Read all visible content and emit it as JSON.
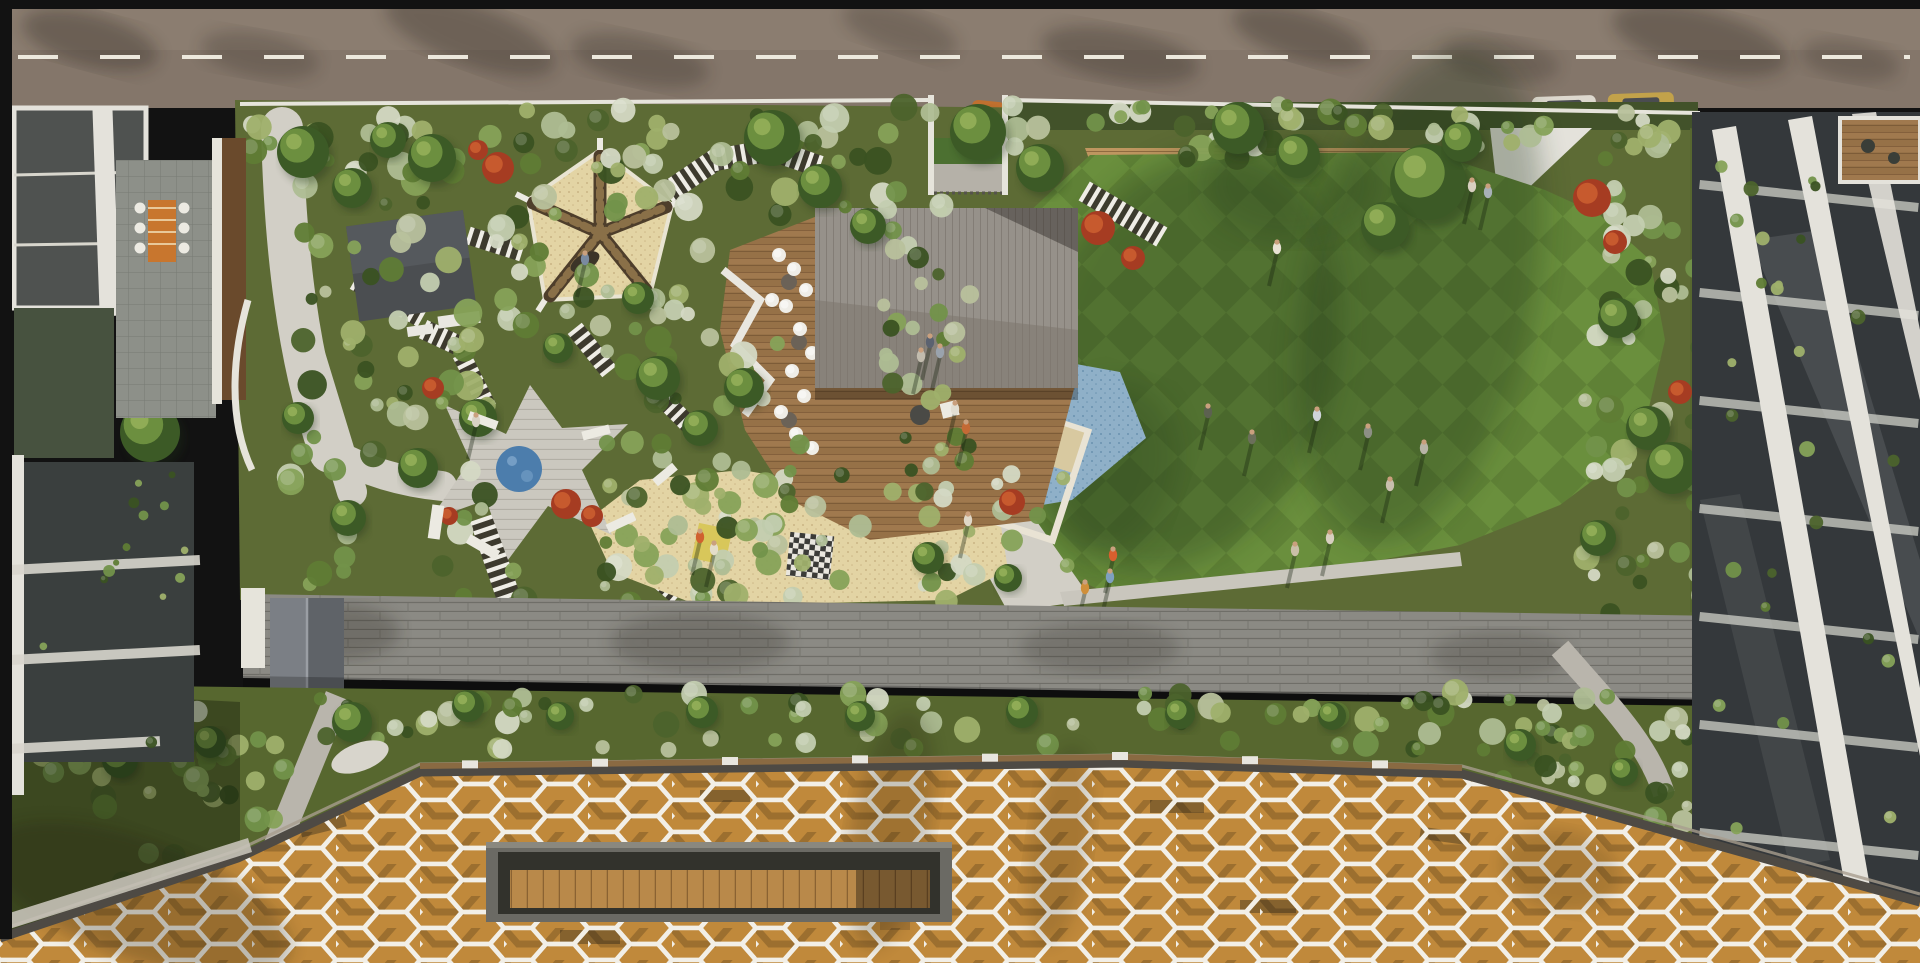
{
  "meta": {
    "description": "Aerial 3D render of a rooftop amenity garden podium between apartment buildings: road with dashed line and parked cars at top, landscaped garden with pavilion, spoke shade tent, spa deck, splash pad, sand play area, striped paths and striped lawn, long stone wall, planting band, and a white hexagonal lattice canopy over a timber roof with a sunken bench void at the bottom.",
    "width": 1920,
    "height": 963
  },
  "palette": {
    "frame": "#121212",
    "road_base": "#84766a",
    "road_light": "#97897a",
    "road_line": "#ece8dd",
    "parapet": "#e6e4db",
    "garden_base": "#5d6b35",
    "hedge_dark": "#42522a",
    "path_light": "#d2cfc6",
    "stripe_white": "#efede6",
    "stripe_dark": "#3a352e",
    "tent_sand": "#d7c89f",
    "tent_arm": "#4e3e2b",
    "tent_arm_stripe": "#8a7048",
    "cabana_roof": "#4b4e51",
    "pavilion_light": "#96918a",
    "pavilion_dark": "#7d776e",
    "deck_wood": "#a0794e",
    "deck_wood_dark": "#7d5c38",
    "deck_light": "#cbc8bf",
    "pool_blue": "#4c7dac",
    "splash_base": "#8fb0c8",
    "splash_dot": "#5f88a8",
    "sand_base": "#e3d4a4",
    "sand_dot": "#c2ab7a",
    "lawn_a": "#5f8136",
    "lawn_b": "#6a8f3d",
    "brick": "#bf9660",
    "brick_line": "#8f6b40",
    "bench_white": "#eceae2",
    "wall_stone": "#8b8a84",
    "wall_joint": "#6f6e68",
    "band_green": "#57672f",
    "canopy_wood": "#c9913f",
    "canopy_wood_dark": "#a87430",
    "lattice": "#f2efe7",
    "fascia": "#4e4a44",
    "void_frame": "#6b6a64",
    "void_dark": "#32322c",
    "void_bench": "#b9894a",
    "bldg_white": "#e4e2db",
    "bldg_glass": "#34383b",
    "bldg_glass2": "#4f5250",
    "tile": "#8d9089",
    "wood_wall": "#6a4a2c",
    "terracotta": "#a95f33",
    "skin": "#caa07e"
  },
  "shrub_colors": {
    "greens": [
      "#4c632c",
      "#5f7c35",
      "#72924a",
      "#86a258",
      "#9fb06b",
      "#3a5222"
    ],
    "sages": [
      "#aebd94",
      "#c3cdb0",
      "#d4d9c4",
      "#b8c19c"
    ]
  },
  "zones": [
    {
      "layer": "podium",
      "x": 245,
      "y": 106,
      "w": 690,
      "h": 110,
      "count": 60,
      "mix": "mixed",
      "rmin": 6,
      "rmax": 15
    },
    {
      "layer": "podium",
      "x": 1010,
      "y": 104,
      "w": 680,
      "h": 58,
      "count": 52,
      "mix": "mixed",
      "rmin": 6,
      "rmax": 14
    },
    {
      "layer": "podium",
      "x": 500,
      "y": 128,
      "w": 220,
      "h": 205,
      "count": 24,
      "mix": "mixed",
      "rmin": 6,
      "rmax": 13
    },
    {
      "layer": "podium",
      "x": 290,
      "y": 140,
      "w": 240,
      "h": 460,
      "count": 70,
      "mix": "mixed",
      "rmin": 6,
      "rmax": 15
    },
    {
      "layer": "podium",
      "x": 600,
      "y": 320,
      "w": 200,
      "h": 285,
      "count": 55,
      "mix": "mixed",
      "rmin": 6,
      "rmax": 14
    },
    {
      "layer": "podium",
      "x": 862,
      "y": 200,
      "w": 108,
      "h": 290,
      "count": 30,
      "mix": "mixed",
      "rmin": 6,
      "rmax": 12
    },
    {
      "layer": "podium",
      "x": 600,
      "y": 470,
      "w": 470,
      "h": 135,
      "count": 42,
      "mix": "mixed",
      "rmin": 5,
      "rmax": 12
    },
    {
      "layer": "podium",
      "x": 1585,
      "y": 118,
      "w": 120,
      "h": 500,
      "count": 55,
      "mix": "mixed",
      "rmin": 6,
      "rmax": 14
    },
    {
      "layer": "band",
      "x": 30,
      "y": 692,
      "w": 1660,
      "h": 58,
      "count": 95,
      "mix": "mixed",
      "rmin": 6,
      "rmax": 14
    },
    {
      "layer": "band",
      "x": 40,
      "y": 742,
      "w": 260,
      "h": 160,
      "count": 40,
      "mix": "greens",
      "rmin": 6,
      "rmax": 13
    },
    {
      "layer": "band",
      "x": 1450,
      "y": 728,
      "w": 320,
      "h": 115,
      "count": 35,
      "mix": "mixed",
      "rmin": 5,
      "rmax": 12
    },
    {
      "layer": "leftbalc",
      "x": 26,
      "y": 470,
      "w": 165,
      "h": 280,
      "count": 14,
      "mix": "greens",
      "rmin": 3,
      "rmax": 6
    },
    {
      "layer": "rightbalc",
      "x": 1716,
      "y": 145,
      "w": 185,
      "h": 690,
      "count": 26,
      "mix": "greens",
      "rmin": 4,
      "rmax": 8
    }
  ],
  "trees": [
    [
      303,
      152,
      26
    ],
    [
      352,
      188,
      20
    ],
    [
      432,
      158,
      24
    ],
    [
      388,
      140,
      18
    ],
    [
      772,
      138,
      28
    ],
    [
      820,
      186,
      22
    ],
    [
      868,
      226,
      18
    ],
    [
      978,
      132,
      28
    ],
    [
      1040,
      168,
      24
    ],
    [
      1238,
      128,
      26
    ],
    [
      1298,
      156,
      22
    ],
    [
      1428,
      182,
      38
    ],
    [
      1385,
      226,
      24
    ],
    [
      1462,
      142,
      20
    ],
    [
      658,
      378,
      22
    ],
    [
      700,
      428,
      18
    ],
    [
      744,
      388,
      20
    ],
    [
      638,
      298,
      16
    ],
    [
      558,
      348,
      15
    ],
    [
      478,
      418,
      19
    ],
    [
      418,
      468,
      20
    ],
    [
      348,
      518,
      18
    ],
    [
      298,
      418,
      16
    ],
    [
      1618,
      318,
      20
    ],
    [
      1648,
      428,
      22
    ],
    [
      1598,
      538,
      18
    ],
    [
      928,
      558,
      16
    ],
    [
      1008,
      578,
      14
    ],
    [
      1672,
      468,
      26
    ],
    [
      150,
      432,
      30
    ],
    [
      205,
      372,
      20
    ]
  ],
  "band_trees": [
    [
      352,
      722,
      20
    ],
    [
      468,
      706,
      16
    ],
    [
      560,
      716,
      14
    ],
    [
      702,
      712,
      16
    ],
    [
      860,
      716,
      15
    ],
    [
      1022,
      712,
      16
    ],
    [
      1180,
      714,
      15
    ],
    [
      1332,
      716,
      14
    ],
    [
      1520,
      745,
      16
    ],
    [
      1624,
      772,
      14
    ],
    [
      120,
      760,
      18
    ],
    [
      210,
      742,
      16
    ]
  ],
  "red_bushes": [
    [
      498,
      168,
      16
    ],
    [
      478,
      150,
      10
    ],
    [
      1098,
      228,
      17
    ],
    [
      1133,
      258,
      12
    ],
    [
      433,
      388,
      11
    ],
    [
      1012,
      502,
      13
    ],
    [
      1592,
      198,
      19
    ],
    [
      1615,
      242,
      12
    ],
    [
      566,
      504,
      15
    ],
    [
      592,
      516,
      11
    ],
    [
      449,
      516,
      9
    ],
    [
      1680,
      392,
      12
    ]
  ],
  "stripes": [
    {
      "x1": 668,
      "y1": 192,
      "x2": 715,
      "y2": 160,
      "w": 22
    },
    {
      "x1": 715,
      "y1": 160,
      "x2": 772,
      "y2": 150,
      "w": 22
    },
    {
      "x1": 772,
      "y1": 150,
      "x2": 818,
      "y2": 166,
      "w": 22
    },
    {
      "x1": 1086,
      "y1": 192,
      "x2": 1160,
      "y2": 236,
      "w": 22
    },
    {
      "x1": 470,
      "y1": 236,
      "x2": 520,
      "y2": 252,
      "w": 18
    },
    {
      "x1": 425,
      "y1": 330,
      "x2": 468,
      "y2": 350,
      "w": 20
    },
    {
      "x1": 462,
      "y1": 356,
      "x2": 487,
      "y2": 406,
      "w": 18
    },
    {
      "x1": 576,
      "y1": 330,
      "x2": 608,
      "y2": 370,
      "w": 18
    },
    {
      "x1": 652,
      "y1": 388,
      "x2": 698,
      "y2": 434,
      "w": 18
    },
    {
      "x1": 482,
      "y1": 520,
      "x2": 508,
      "y2": 596,
      "w": 24
    },
    {
      "x1": 634,
      "y1": 560,
      "x2": 676,
      "y2": 596,
      "w": 16
    },
    {
      "x1": 356,
      "y1": 282,
      "x2": 420,
      "y2": 318,
      "w": 18
    }
  ],
  "cars": [
    {
      "x": 971,
      "y": 101,
      "w": 33,
      "h": 31,
      "rot": 6,
      "body": "#c0702f",
      "cabin": "#33343a"
    },
    {
      "x": 1532,
      "y": 96,
      "w": 64,
      "h": 20,
      "rot": -2,
      "body": "#ddd8ce",
      "cabin": "#4a4c50"
    },
    {
      "x": 1608,
      "y": 93,
      "w": 66,
      "h": 22,
      "rot": -2,
      "body": "#c2a24a",
      "cabin": "#4a4c50"
    }
  ],
  "lawn_people": [
    [
      1277,
      248,
      "#e8e2d4"
    ],
    [
      1252,
      438,
      "#6b6f5a"
    ],
    [
      1317,
      415,
      "#cfd4da"
    ],
    [
      1368,
      432,
      "#8d8f85"
    ],
    [
      1424,
      448,
      "#b8b4a6"
    ],
    [
      1390,
      485,
      "#c8bfae"
    ],
    [
      1330,
      538,
      "#d8cfc0"
    ],
    [
      1295,
      550,
      "#cabfa8"
    ],
    [
      1208,
      412,
      "#5c6150"
    ],
    [
      1472,
      186,
      "#d8d0c0"
    ],
    [
      1488,
      192,
      "#a8b0b8"
    ]
  ],
  "misc_people": [
    [
      585,
      259,
      "#7a8aa0"
    ],
    [
      476,
      421,
      "#d8d2c4"
    ],
    [
      955,
      409,
      "#e2ded2"
    ],
    [
      966,
      428,
      "#c46a35"
    ],
    [
      700,
      537,
      "#d0612f"
    ],
    [
      714,
      549,
      "#e4ddc9"
    ],
    [
      930,
      342,
      "#5b6270"
    ],
    [
      940,
      352,
      "#9aa3ad"
    ],
    [
      921,
      356,
      "#c2bcae"
    ],
    [
      1113,
      555,
      "#d95f2e"
    ],
    [
      1110,
      577,
      "#7fa0c0"
    ],
    [
      1085,
      588,
      "#cf8f3a"
    ],
    [
      968,
      520,
      "#e0d8c8"
    ],
    [
      686,
      662,
      "#d06a2a"
    ]
  ],
  "white_benches": [
    [
      468,
      416,
      30,
      9,
      20
    ],
    [
      582,
      428,
      28,
      9,
      -15
    ],
    [
      466,
      542,
      34,
      10,
      30
    ],
    [
      606,
      518,
      30,
      9,
      -25
    ],
    [
      430,
      505,
      12,
      34,
      8
    ],
    [
      652,
      470,
      26,
      9,
      -40
    ]
  ],
  "stools": [
    [
      779,
      255
    ],
    [
      794,
      269
    ],
    [
      806,
      290
    ],
    [
      786,
      306
    ],
    [
      800,
      329
    ],
    [
      812,
      353
    ],
    [
      792,
      371
    ],
    [
      804,
      396
    ],
    [
      781,
      412
    ],
    [
      796,
      434
    ],
    [
      812,
      448
    ],
    [
      772,
      300
    ]
  ],
  "stool_tables": [
    [
      789,
      282
    ],
    [
      799,
      342
    ],
    [
      789,
      420
    ]
  ],
  "road_shadows": [
    [
      90,
      40,
      70,
      26,
      15,
      0.3
    ],
    [
      260,
      55,
      60,
      22,
      10,
      0.22
    ],
    [
      470,
      35,
      90,
      30,
      20,
      0.28
    ],
    [
      640,
      60,
      70,
      24,
      12,
      0.25
    ],
    [
      900,
      30,
      60,
      22,
      18,
      0.22
    ],
    [
      1120,
      55,
      80,
      26,
      10,
      0.28
    ],
    [
      1300,
      35,
      70,
      24,
      16,
      0.3
    ],
    [
      1500,
      60,
      60,
      22,
      8,
      0.22
    ],
    [
      1700,
      40,
      90,
      30,
      14,
      0.3
    ],
    [
      1850,
      60,
      50,
      20,
      10,
      0.22
    ]
  ],
  "lawn_shadows": [
    [
      1185,
      360,
      150,
      215,
      18,
      0.3
    ],
    [
      1420,
      295,
      115,
      250,
      12,
      0.3
    ],
    [
      1290,
      185,
      85,
      55,
      0,
      0.22
    ],
    [
      1105,
      470,
      70,
      90,
      20,
      0.22
    ]
  ],
  "wall_shadows": [
    [
      340,
      632,
      60,
      28,
      0,
      0.25
    ],
    [
      700,
      642,
      90,
      30,
      0,
      0.22
    ],
    [
      1100,
      648,
      80,
      26,
      0,
      0.2
    ],
    [
      1500,
      655,
      70,
      24,
      0,
      0.2
    ]
  ],
  "canopy_shadows": [
    [
      890,
      830,
      40,
      120,
      10,
      0.2
    ],
    [
      1060,
      845,
      30,
      100,
      8,
      0.16
    ],
    [
      140,
      900,
      160,
      60,
      20,
      0.25
    ],
    [
      1560,
      870,
      60,
      40,
      10,
      0.15
    ]
  ],
  "rail_posts_x": [
    470,
    600,
    730,
    860,
    990,
    1120,
    1250,
    1380
  ]
}
